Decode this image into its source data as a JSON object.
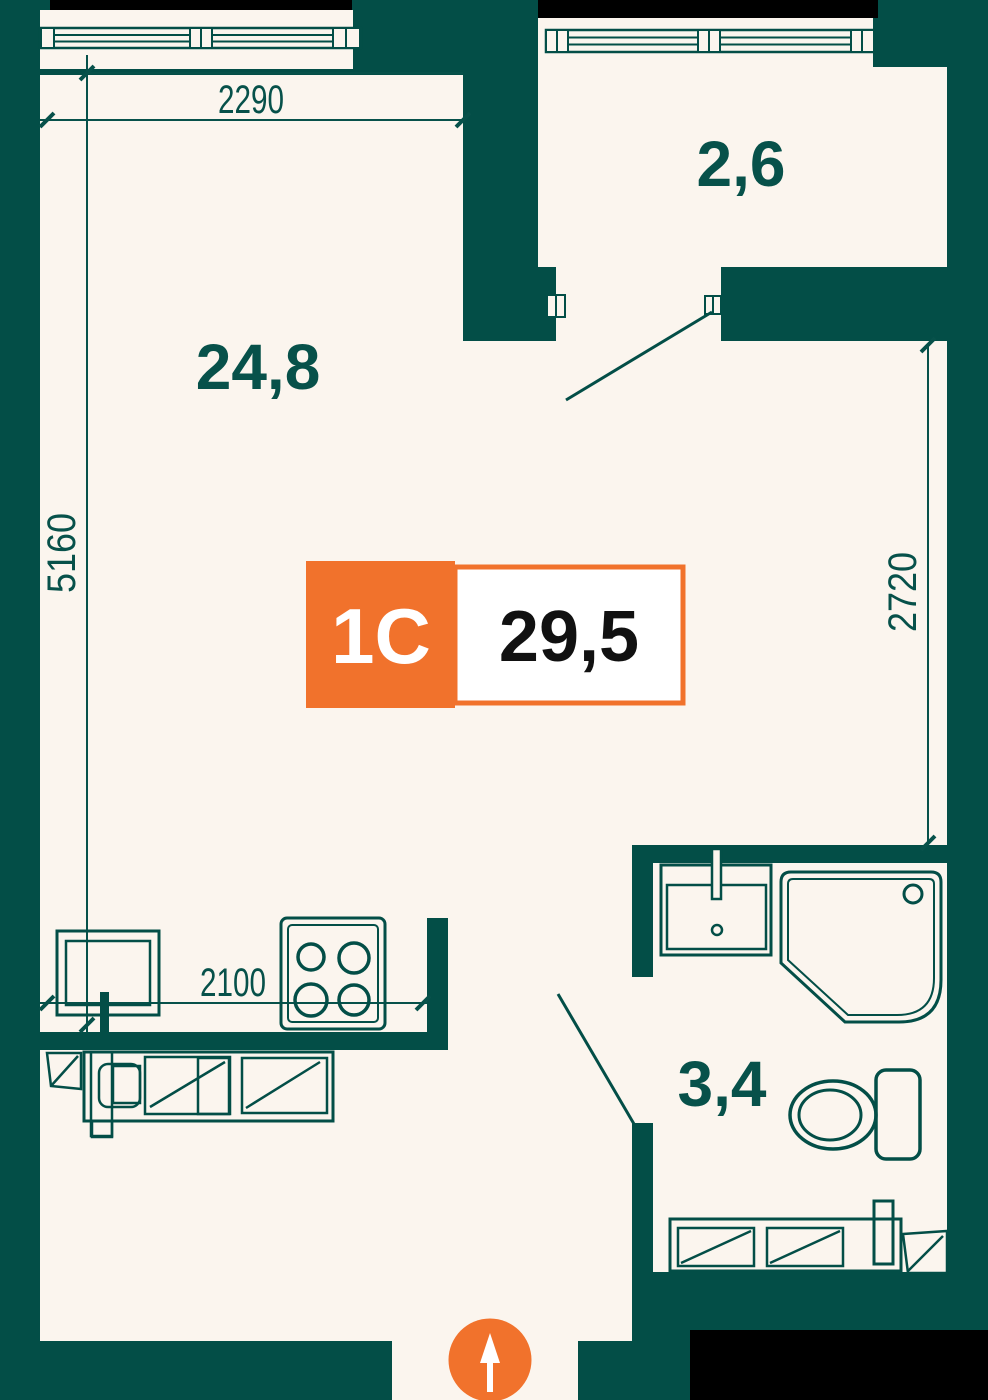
{
  "badge": {
    "type_label": "1С",
    "area_label": "29,5"
  },
  "rooms": [
    {
      "id": "living-kitchen",
      "area_label": "24,8"
    },
    {
      "id": "balcony",
      "area_label": "2,6"
    },
    {
      "id": "bathroom",
      "area_label": "3,4"
    }
  ],
  "dimensions": [
    {
      "id": "top-width",
      "value": "2290"
    },
    {
      "id": "left-height",
      "value": "5160"
    },
    {
      "id": "right-height",
      "value": "2720"
    },
    {
      "id": "kitchen-width",
      "value": "2100"
    }
  ],
  "icons": {
    "north_arrow": "north-arrow-icon",
    "window": "window-symbol",
    "stove": "stove-icon",
    "kitchen_sink": "kitchen-sink-icon",
    "bath_sink": "washbasin-icon",
    "shower": "shower-tray-icon",
    "toilet": "toilet-icon"
  },
  "colors": {
    "wall_teal": "#034E47",
    "floor_cream": "#FBF5EE",
    "accent_orange": "#F1722C",
    "badge_text_dark": "#111111",
    "outline_black": "#000000",
    "label_teal": "#07514A"
  }
}
